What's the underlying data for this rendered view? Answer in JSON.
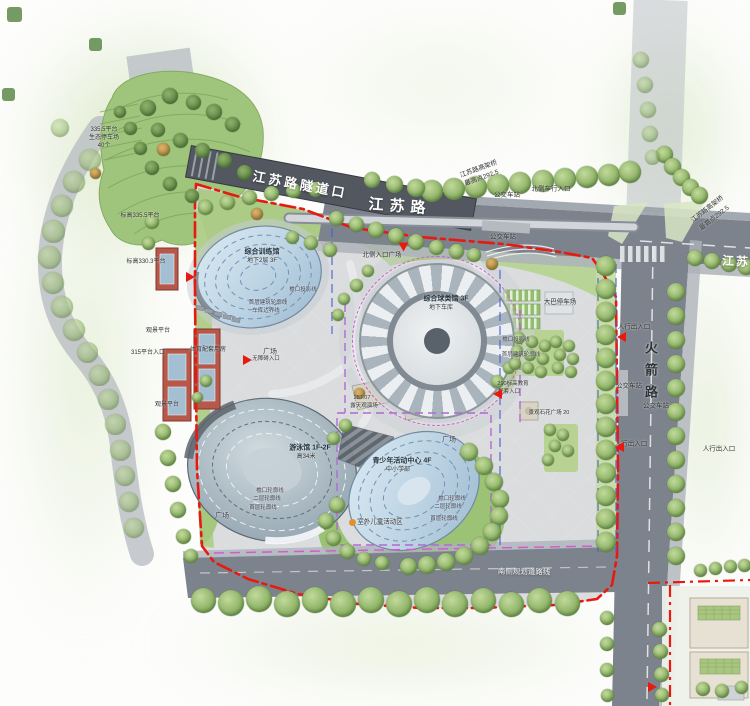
{
  "palette": {
    "boundary_red": "#e8190f",
    "garage_magenta": "#cf5ad2",
    "garage_purple": "#b06ad0",
    "parcel_blue": "#4a5fd0",
    "road_gray": "#7d838c",
    "tunnel_gray": "#53575f",
    "paving": "#dadcde",
    "green_bright": "#accb86",
    "glass_blue": "#c3d8e8",
    "red_building": "#b8584a"
  },
  "labels": [
    {
      "name": "tunnel-name",
      "text": "江苏路隧道口",
      "x": 300,
      "y": 185,
      "size": 13,
      "rot": 10.5,
      "color": "#ffffff",
      "weight": "bold",
      "ls": 3,
      "onroad": true
    },
    {
      "name": "jiangsu-road-label",
      "text": "江苏路",
      "x": 400,
      "y": 207,
      "size": 15,
      "rot": 4,
      "color": "#ffffff",
      "weight": "bold",
      "ls": 6,
      "onroad": true
    },
    {
      "name": "jiangsu-road-label-east",
      "text": "江苏路",
      "x": 743,
      "y": 262,
      "size": 12,
      "rot": 3,
      "color": "#ffffff",
      "weight": "bold",
      "ls": 2,
      "onroad": true
    },
    {
      "name": "rocket-road-label",
      "text": "火箭路",
      "x": 650,
      "y": 374,
      "size": 13,
      "rot": 0,
      "color": "#2e3338",
      "weight": "bold",
      "ls": 9,
      "vertical": true
    },
    {
      "name": "viaduct-label-1a",
      "text": "江苏路高架桥",
      "x": 479,
      "y": 170,
      "size": 6.5,
      "rot": -20
    },
    {
      "name": "viaduct-label-1b",
      "text": "最高点292.5",
      "x": 482,
      "y": 179,
      "size": 6.5,
      "rot": -20
    },
    {
      "name": "viaduct-label-2a",
      "text": "江苏路高架桥",
      "x": 708,
      "y": 210,
      "size": 6.5,
      "rot": -38
    },
    {
      "name": "viaduct-label-2b",
      "text": "最高点292.5",
      "x": 715,
      "y": 219,
      "size": 6.5,
      "rot": -38
    },
    {
      "name": "bus-stop-1",
      "text": "公交车站",
      "x": 507,
      "y": 196,
      "size": 6.5
    },
    {
      "name": "bus-stop-2",
      "text": "公交车站",
      "x": 503,
      "y": 238,
      "size": 6.5
    },
    {
      "name": "bus-stop-3",
      "text": "公交车站",
      "x": 629,
      "y": 387,
      "size": 6.5
    },
    {
      "name": "bus-stop-4",
      "text": "公交车站",
      "x": 656,
      "y": 407,
      "size": 6.5
    },
    {
      "name": "north-vehicle-entrance",
      "text": "北侧车行入口",
      "x": 551,
      "y": 190,
      "size": 6.5
    },
    {
      "name": "north-entrance-plaza",
      "text": "北侧入口广场",
      "x": 382,
      "y": 256,
      "size": 6.5
    },
    {
      "name": "bus-parking",
      "text": "大巴停车场",
      "x": 560,
      "y": 303,
      "size": 6.5
    },
    {
      "name": "ped-entrance-1",
      "text": "人行出入口",
      "x": 634,
      "y": 328,
      "size": 6.5
    },
    {
      "name": "ped-entrance-2",
      "text": "人行出入口",
      "x": 631,
      "y": 445,
      "size": 6.5
    },
    {
      "name": "ped-entrance-3",
      "text": "人行出入口",
      "x": 719,
      "y": 450,
      "size": 6.5
    },
    {
      "name": "viewing-platform-1",
      "text": "观景平台",
      "x": 158,
      "y": 331,
      "size": 6
    },
    {
      "name": "platform-315-entrance",
      "text": "315平台入口",
      "x": 148,
      "y": 353,
      "size": 6
    },
    {
      "name": "viewing-platform-2",
      "text": "观景平台",
      "x": 167,
      "y": 405,
      "size": 6
    },
    {
      "name": "sports-support-rooms",
      "text": "体育配套用房",
      "x": 208,
      "y": 350,
      "size": 6
    },
    {
      "name": "elevation-330",
      "text": "标高330.3平台",
      "x": 146,
      "y": 262,
      "size": 6
    },
    {
      "name": "eco-parking-1",
      "text": "335.5平台",
      "x": 104,
      "y": 130,
      "size": 6
    },
    {
      "name": "eco-parking-2",
      "text": "生态停车场",
      "x": 104,
      "y": 138,
      "size": 6
    },
    {
      "name": "eco-parking-3",
      "text": "40个",
      "x": 104,
      "y": 146,
      "size": 6
    },
    {
      "name": "elevation-335",
      "text": "标高335.5平台",
      "x": 140,
      "y": 216,
      "size": 6
    },
    {
      "name": "training-hall-name",
      "text": "综合训练馆",
      "x": 262,
      "y": 252,
      "size": 7,
      "color": "#1d2d3a",
      "weight": "bold"
    },
    {
      "name": "training-hall-floors",
      "text": "地下2层 3F",
      "x": 262,
      "y": 261,
      "size": 6
    },
    {
      "name": "leader-eave-1",
      "text": "檐口投影线",
      "x": 303,
      "y": 291,
      "size": 5.5,
      "color": "#445"
    },
    {
      "name": "leader-outline-1",
      "text": "首层建筑轮廓线",
      "x": 268,
      "y": 304,
      "size": 5.5,
      "color": "#445"
    },
    {
      "name": "leader-garage-1",
      "text": "车库边界线",
      "x": 266,
      "y": 312,
      "size": 5.5,
      "color": "#445"
    },
    {
      "name": "ball-hall-name",
      "text": "综合球类馆 3F",
      "x": 446,
      "y": 299,
      "size": 7,
      "color": "#1d2d3a",
      "weight": "bold"
    },
    {
      "name": "ball-hall-floors",
      "text": "地下车库",
      "x": 441,
      "y": 308,
      "size": 6
    },
    {
      "name": "leader-eave-2",
      "text": "檐口投影线",
      "x": 516,
      "y": 341,
      "size": 5.5,
      "color": "#445"
    },
    {
      "name": "leader-outline-2",
      "text": "首层建筑轮廓线",
      "x": 521,
      "y": 356,
      "size": 5.5,
      "color": "#445"
    },
    {
      "name": "natatorium-name",
      "text": "游泳馆 1F-2F",
      "x": 310,
      "y": 448,
      "size": 7,
      "color": "#1d2d3a",
      "weight": "bold"
    },
    {
      "name": "natatorium-height",
      "text": "高34米",
      "x": 306,
      "y": 457,
      "size": 6
    },
    {
      "name": "leader-eave-3",
      "text": "檐口轮廓线",
      "x": 270,
      "y": 492,
      "size": 5.5,
      "color": "#445"
    },
    {
      "name": "leader-second-3",
      "text": "二层轮廓线",
      "x": 267,
      "y": 500,
      "size": 5.5,
      "color": "#445"
    },
    {
      "name": "leader-first-3",
      "text": "首层轮廓线",
      "x": 263,
      "y": 509,
      "size": 5.5,
      "color": "#445"
    },
    {
      "name": "plaza-label-1",
      "text": "广场",
      "x": 222,
      "y": 516,
      "size": 7,
      "color": "#3a4148"
    },
    {
      "name": "plaza-label-2",
      "text": "广场",
      "x": 270,
      "y": 352,
      "size": 7,
      "color": "#3a4148"
    },
    {
      "name": "plaza-label-3",
      "text": "广场",
      "x": 449,
      "y": 440,
      "size": 7,
      "color": "#3a4148"
    },
    {
      "name": "youth-center-name",
      "text": "青少年活动中心 4F",
      "x": 402,
      "y": 461,
      "size": 7,
      "color": "#1d2d3a",
      "weight": "bold"
    },
    {
      "name": "youth-center-sub",
      "text": "中小学部",
      "x": 398,
      "y": 470,
      "size": 6
    },
    {
      "name": "leader-eave-4",
      "text": "檐口轮廓线",
      "x": 452,
      "y": 500,
      "size": 5.5,
      "color": "#445"
    },
    {
      "name": "leader-second-4",
      "text": "二层轮廓线",
      "x": 448,
      "y": 508,
      "size": 5.5,
      "color": "#445"
    },
    {
      "name": "leader-first-4",
      "text": "首层轮廓线",
      "x": 444,
      "y": 520,
      "size": 5.5,
      "color": "#445"
    },
    {
      "name": "kids-area-label",
      "text": "室外儿童活动区",
      "x": 380,
      "y": 523,
      "size": 6.5
    },
    {
      "name": "amphitheater-elev",
      "text": "287.07",
      "x": 362,
      "y": 399,
      "size": 5.5
    },
    {
      "name": "amphitheater-name",
      "text": "露天观演场",
      "x": 364,
      "y": 407,
      "size": 5.5
    },
    {
      "name": "edu-entrance-1",
      "text": "290标高教育",
      "x": 513,
      "y": 385,
      "size": 5.5
    },
    {
      "name": "edu-entrance-2",
      "text": "配套入口",
      "x": 509,
      "y": 393,
      "size": 5.5
    },
    {
      "name": "stone-plaza",
      "text": "景观石花广场 20",
      "x": 549,
      "y": 414,
      "size": 5.5
    },
    {
      "name": "south-road-label",
      "text": "南侧规划道路线",
      "x": 524,
      "y": 572,
      "size": 7.5,
      "rot": 1,
      "color": "#eef0f2",
      "onroad": true
    },
    {
      "name": "accessible-entrance",
      "text": "无障碍入口",
      "x": 266,
      "y": 360,
      "size": 5.5
    }
  ],
  "trees": {
    "street": [
      [
        432,
        191,
        22
      ],
      [
        454,
        189,
        22
      ],
      [
        476,
        187,
        22
      ],
      [
        498,
        185,
        22
      ],
      [
        520,
        183,
        22
      ],
      [
        543,
        181,
        22
      ],
      [
        565,
        179,
        22
      ],
      [
        587,
        177,
        22
      ],
      [
        609,
        175,
        22
      ],
      [
        630,
        172,
        22
      ],
      [
        664,
        154,
        17
      ],
      [
        672,
        166,
        17
      ],
      [
        681,
        177,
        17
      ],
      [
        690,
        187,
        17
      ],
      [
        699,
        195,
        17
      ],
      [
        695,
        258,
        16
      ],
      [
        712,
        261,
        16
      ],
      [
        729,
        264,
        16
      ],
      [
        746,
        267,
        16
      ],
      [
        372,
        180,
        16
      ],
      [
        394,
        184,
        17
      ],
      [
        416,
        188,
        18
      ],
      [
        606,
        266,
        20
      ],
      [
        606,
        289,
        20
      ],
      [
        606,
        312,
        20
      ],
      [
        606,
        335,
        20
      ],
      [
        606,
        358,
        20
      ],
      [
        606,
        381,
        20
      ],
      [
        606,
        404,
        20
      ],
      [
        606,
        427,
        20
      ],
      [
        606,
        450,
        20
      ],
      [
        606,
        473,
        20
      ],
      [
        606,
        496,
        20
      ],
      [
        606,
        519,
        20
      ],
      [
        606,
        542,
        20
      ],
      [
        676,
        292,
        18
      ],
      [
        676,
        316,
        18
      ],
      [
        676,
        340,
        18
      ],
      [
        676,
        364,
        18
      ],
      [
        676,
        388,
        18
      ],
      [
        676,
        412,
        18
      ],
      [
        676,
        436,
        18
      ],
      [
        676,
        460,
        18
      ],
      [
        676,
        484,
        18
      ],
      [
        676,
        508,
        18
      ],
      [
        676,
        532,
        18
      ],
      [
        676,
        556,
        18
      ],
      [
        203,
        600,
        25
      ],
      [
        231,
        603,
        26
      ],
      [
        259,
        599,
        26
      ],
      [
        287,
        604,
        26
      ],
      [
        315,
        600,
        26
      ],
      [
        343,
        604,
        26
      ],
      [
        371,
        600,
        26
      ],
      [
        399,
        604,
        26
      ],
      [
        427,
        600,
        26
      ],
      [
        455,
        604,
        26
      ],
      [
        483,
        600,
        25
      ],
      [
        511,
        604,
        25
      ],
      [
        539,
        600,
        25
      ],
      [
        567,
        603,
        25
      ],
      [
        700,
        570,
        13
      ],
      [
        715,
        568,
        13
      ],
      [
        730,
        566,
        13
      ],
      [
        744,
        565,
        13
      ],
      [
        205,
        207,
        15
      ],
      [
        227,
        202,
        15
      ],
      [
        249,
        197,
        15
      ],
      [
        271,
        193,
        15
      ],
      [
        293,
        190,
        15
      ],
      [
        315,
        189,
        15
      ],
      [
        336,
        218,
        15
      ],
      [
        356,
        224,
        15
      ],
      [
        376,
        230,
        16
      ],
      [
        396,
        236,
        16
      ],
      [
        416,
        242,
        16
      ],
      [
        436,
        247,
        15
      ],
      [
        456,
        251,
        15
      ],
      [
        474,
        255,
        14
      ],
      [
        311,
        243,
        14
      ],
      [
        330,
        250,
        14
      ],
      [
        292,
        237,
        13
      ],
      [
        163,
        432,
        16
      ],
      [
        168,
        458,
        16
      ],
      [
        173,
        484,
        16
      ],
      [
        178,
        510,
        16
      ],
      [
        183,
        536,
        15
      ],
      [
        191,
        556,
        14
      ],
      [
        152,
        222,
        14
      ],
      [
        148,
        243,
        13
      ],
      [
        356,
        285,
        13
      ],
      [
        368,
        271,
        12
      ],
      [
        344,
        299,
        12
      ],
      [
        338,
        315,
        12
      ],
      [
        497,
        381,
        13
      ],
      [
        509,
        368,
        12
      ],
      [
        469,
        452,
        18
      ],
      [
        484,
        466,
        18
      ],
      [
        494,
        482,
        18
      ],
      [
        500,
        499,
        18
      ],
      [
        499,
        516,
        18
      ],
      [
        492,
        532,
        18
      ],
      [
        480,
        546,
        18
      ],
      [
        464,
        556,
        18
      ],
      [
        446,
        562,
        18
      ],
      [
        427,
        565,
        18
      ],
      [
        408,
        566,
        17
      ],
      [
        337,
        505,
        16
      ],
      [
        326,
        521,
        16
      ],
      [
        333,
        538,
        15
      ],
      [
        347,
        551,
        15
      ],
      [
        364,
        559,
        14
      ],
      [
        382,
        563,
        14
      ],
      [
        345,
        425,
        13
      ],
      [
        333,
        438,
        13
      ],
      [
        206,
        381,
        12
      ],
      [
        197,
        397,
        11
      ],
      [
        519,
        338,
        12
      ],
      [
        532,
        342,
        12
      ],
      [
        545,
        346,
        12
      ],
      [
        517,
        351,
        12
      ],
      [
        530,
        355,
        12
      ],
      [
        543,
        359,
        12
      ],
      [
        515,
        364,
        12
      ],
      [
        528,
        368,
        12
      ],
      [
        541,
        372,
        12
      ],
      [
        556,
        342,
        12
      ],
      [
        569,
        346,
        12
      ],
      [
        560,
        355,
        12
      ],
      [
        573,
        359,
        12
      ],
      [
        558,
        368,
        12
      ],
      [
        571,
        372,
        12
      ],
      [
        550,
        430,
        12
      ],
      [
        563,
        435,
        12
      ],
      [
        555,
        446,
        12
      ],
      [
        568,
        451,
        12
      ],
      [
        548,
        460,
        12
      ],
      [
        659,
        629,
        15
      ],
      [
        660,
        651,
        15
      ],
      [
        661,
        674,
        15
      ],
      [
        662,
        695,
        14
      ],
      [
        703,
        689,
        14
      ],
      [
        722,
        691,
        14
      ],
      [
        741,
        687,
        13
      ],
      [
        607,
        618,
        14
      ],
      [
        607,
        644,
        14
      ],
      [
        607,
        670,
        14
      ],
      [
        607,
        695,
        13
      ]
    ],
    "dark": [
      [
        148,
        108,
        16
      ],
      [
        170,
        96,
        16
      ],
      [
        193,
        102,
        15
      ],
      [
        214,
        112,
        16
      ],
      [
        232,
        124,
        15
      ],
      [
        158,
        130,
        14
      ],
      [
        180,
        140,
        15
      ],
      [
        202,
        150,
        15
      ],
      [
        224,
        160,
        15
      ],
      [
        244,
        172,
        15
      ],
      [
        140,
        148,
        13
      ],
      [
        152,
        168,
        14
      ],
      [
        170,
        184,
        14
      ],
      [
        192,
        196,
        14
      ],
      [
        130,
        128,
        13
      ],
      [
        120,
        112,
        12
      ]
    ],
    "pale": [
      [
        90,
        160,
        22
      ],
      [
        74,
        182,
        22
      ],
      [
        62,
        206,
        22
      ],
      [
        53,
        231,
        23
      ],
      [
        49,
        257,
        23
      ],
      [
        53,
        283,
        22
      ],
      [
        62,
        307,
        22
      ],
      [
        74,
        330,
        22
      ],
      [
        87,
        352,
        21
      ],
      [
        99,
        375,
        21
      ],
      [
        108,
        399,
        21
      ],
      [
        115,
        424,
        21
      ],
      [
        120,
        450,
        21
      ],
      [
        125,
        476,
        20
      ],
      [
        129,
        502,
        20
      ],
      [
        134,
        528,
        20
      ],
      [
        641,
        60,
        16
      ],
      [
        645,
        85,
        16
      ],
      [
        648,
        110,
        16
      ],
      [
        650,
        134,
        16
      ],
      [
        652,
        157,
        15
      ],
      [
        60,
        128,
        18
      ]
    ],
    "orange": [
      [
        163,
        149,
        13
      ],
      [
        95,
        173,
        11
      ],
      [
        257,
        214,
        12
      ],
      [
        492,
        264,
        12
      ],
      [
        359,
        393,
        11
      ]
    ],
    "shrubs": [
      [
        14,
        14,
        15
      ],
      [
        95,
        44,
        13
      ],
      [
        8,
        94,
        13
      ],
      [
        619,
        8,
        13
      ]
    ]
  },
  "arrows": [
    {
      "name": "north-plaza-entrance-arrow",
      "x": 403,
      "y": 247,
      "rot": 90
    },
    {
      "name": "platform-entrance-arrow",
      "x": 190,
      "y": 277,
      "rot": 0
    },
    {
      "name": "accessible-entrance-arrow",
      "x": 247,
      "y": 360,
      "rot": 0
    },
    {
      "name": "edu-entrance-arrow",
      "x": 497,
      "y": 394,
      "rot": 180
    },
    {
      "name": "ped-entrance-arrow-1",
      "x": 621,
      "y": 337,
      "rot": 180
    },
    {
      "name": "ped-entrance-arrow-2",
      "x": 619,
      "y": 447,
      "rot": 180
    },
    {
      "name": "parcel-entrance-arrow",
      "x": 652,
      "y": 687,
      "rot": 0
    }
  ],
  "markers": [
    {
      "name": "kids-area-marker",
      "x": 352,
      "y": 522,
      "d": 7,
      "color": "#e0922f"
    }
  ]
}
